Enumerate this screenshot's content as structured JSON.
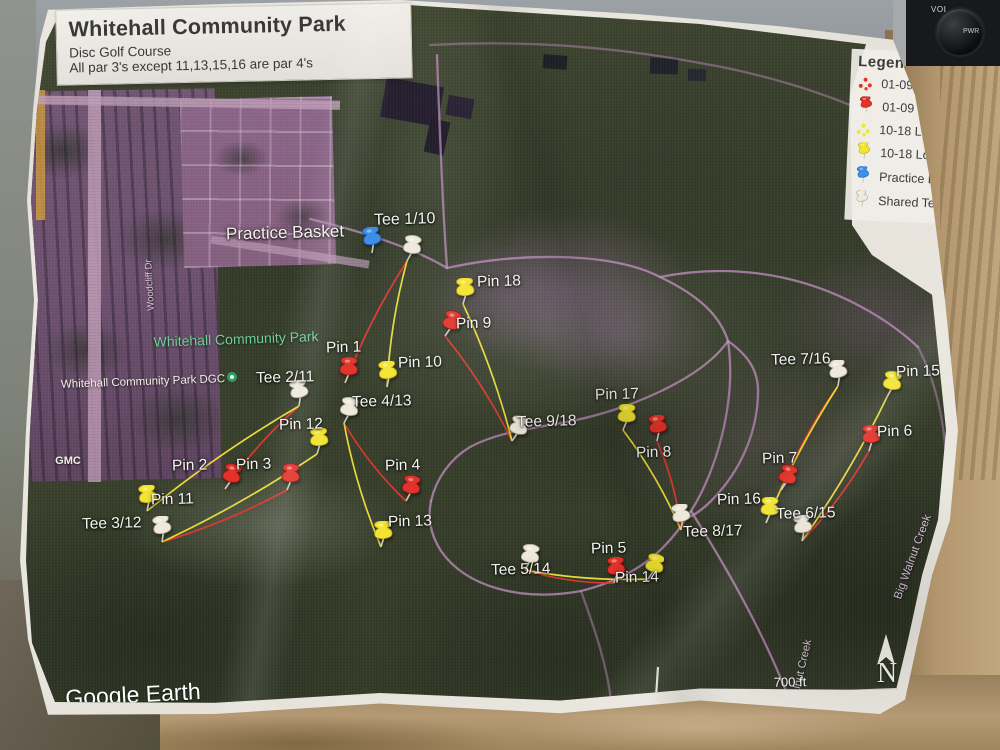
{
  "photo": {
    "radio": {
      "vol": "VOL",
      "pwr": "PWR"
    }
  },
  "header": {
    "title": "Whitehall Community Park",
    "subtitle": "Disc Golf Course",
    "par_note": "All par 3's except 11,13,15,16 are par 4's"
  },
  "legend": {
    "title": "Legend",
    "items": [
      {
        "icon": "dots-short",
        "label": "01-09 Short Holes"
      },
      {
        "icon": "pin-short",
        "label": "01-09 Short Pins"
      },
      {
        "icon": "dots-long",
        "label": "10-18 Long Holes"
      },
      {
        "icon": "pin-long",
        "label": "10-18 Long Pins"
      },
      {
        "icon": "pin-practice",
        "label": "Practice Basket"
      },
      {
        "icon": "pin-tee",
        "label": "Shared Tee Pads"
      }
    ]
  },
  "map": {
    "colors": {
      "short": "#e23229",
      "short_edge": "#8e1613",
      "short_line": "#e0392f",
      "long": "#f2e430",
      "long_edge": "#b8a51a",
      "long_line": "#efe23c",
      "tee": "#efe9dc",
      "tee_edge": "#a39c8e",
      "practice": "#3e8ee6",
      "practice_edge": "#1c5fae",
      "trail": "#c08ec0"
    },
    "markers": [
      {
        "id": "practice-basket",
        "type": "blue",
        "x": 372,
        "y": 253,
        "label": "Practice Basket",
        "dx": -146,
        "dy": -30,
        "size": 17
      },
      {
        "id": "tee-1-10",
        "type": "white",
        "x": 407,
        "y": 261,
        "label": "Tee 1/10",
        "dx": -33,
        "dy": -50,
        "size": 16
      },
      {
        "id": "pin-18",
        "type": "yellow",
        "x": 463,
        "y": 304,
        "label": "Pin 18",
        "dx": 14,
        "dy": -31
      },
      {
        "id": "pin-9",
        "type": "red",
        "x": 445,
        "y": 336,
        "label": "Pin 9",
        "dx": 11,
        "dy": -21
      },
      {
        "id": "pin-1",
        "type": "red",
        "x": 345,
        "y": 383,
        "label": "Pin 1",
        "dx": -19,
        "dy": -44
      },
      {
        "id": "pin-10",
        "type": "yellow",
        "x": 387,
        "y": 387,
        "label": "Pin 10",
        "dx": 11,
        "dy": -33
      },
      {
        "id": "tee-2-11",
        "type": "white",
        "x": 299,
        "y": 406,
        "label": "Tee 2/11",
        "dx": -43,
        "dy": -37
      },
      {
        "id": "tee-4-13",
        "type": "white",
        "x": 344,
        "y": 423,
        "label": "Tee 4/13",
        "dx": 8,
        "dy": -30
      },
      {
        "id": "pin-12",
        "type": "yellow",
        "x": 317,
        "y": 454,
        "label": "Pin 12",
        "dx": -38,
        "dy": -38
      },
      {
        "id": "pin-2",
        "type": "red",
        "x": 225,
        "y": 489,
        "label": "Pin 2",
        "dx": -53,
        "dy": -32
      },
      {
        "id": "pin-3",
        "type": "red",
        "x": 287,
        "y": 490,
        "label": "Pin 3",
        "dx": -51,
        "dy": -34
      },
      {
        "id": "pin-11",
        "type": "yellow",
        "x": 147,
        "y": 511,
        "label": "Pin 11",
        "dx": 4,
        "dy": -20
      },
      {
        "id": "tee-3-12",
        "type": "white",
        "x": 162,
        "y": 542,
        "label": "Tee 3/12",
        "dx": -80,
        "dy": -27
      },
      {
        "id": "pin-4",
        "type": "red",
        "x": 406,
        "y": 501,
        "label": "Pin 4",
        "dx": -21,
        "dy": -44
      },
      {
        "id": "pin-13",
        "type": "yellow",
        "x": 381,
        "y": 547,
        "label": "Pin 13",
        "dx": 7,
        "dy": -34
      },
      {
        "id": "tee-9-18",
        "type": "white",
        "x": 512,
        "y": 441,
        "label": "Tee 9/18",
        "dx": 5,
        "dy": -28
      },
      {
        "id": "pin-17",
        "type": "yellow",
        "x": 623,
        "y": 430,
        "label": "Pin 17",
        "dx": -28,
        "dy": -44
      },
      {
        "id": "pin-8",
        "type": "red",
        "x": 657,
        "y": 441,
        "label": "Pin 8",
        "dx": -21,
        "dy": 3
      },
      {
        "id": "tee-7-16",
        "type": "white",
        "x": 838,
        "y": 386,
        "label": "Tee 7/16",
        "dx": -67,
        "dy": -35
      },
      {
        "id": "pin-15",
        "type": "yellow",
        "x": 887,
        "y": 397,
        "label": "Pin 15",
        "dx": 9,
        "dy": -34
      },
      {
        "id": "pin-6",
        "type": "red",
        "x": 869,
        "y": 451,
        "label": "Pin 6",
        "dx": 8,
        "dy": -28
      },
      {
        "id": "pin-7",
        "type": "red",
        "x": 781,
        "y": 490,
        "label": "Pin 7",
        "dx": -19,
        "dy": -40
      },
      {
        "id": "pin-16",
        "type": "yellow",
        "x": 766,
        "y": 523,
        "label": "Pin 16",
        "dx": -49,
        "dy": -32
      },
      {
        "id": "tee-6-15",
        "type": "white",
        "x": 802,
        "y": 541,
        "label": "Tee 6/15",
        "dx": -26,
        "dy": -36
      },
      {
        "id": "tee-8-17",
        "type": "white",
        "x": 681,
        "y": 530,
        "label": "Tee 8/17",
        "dx": 2,
        "dy": -7
      },
      {
        "id": "tee-5-14",
        "type": "white",
        "x": 525,
        "y": 570,
        "label": "Tee 5/14",
        "dx": -34,
        "dy": -9
      },
      {
        "id": "pin-5",
        "type": "red",
        "x": 614,
        "y": 583,
        "label": "Pin 5",
        "dx": -23,
        "dy": -43
      },
      {
        "id": "pin-14",
        "type": "yellow",
        "x": 648,
        "y": 579,
        "label": "Pin 14",
        "dx": -33,
        "dy": -10
      }
    ],
    "fairways": [
      {
        "hole": "1",
        "from": "tee-1-10",
        "to": "pin-1",
        "type": "short"
      },
      {
        "hole": "10",
        "from": "tee-1-10",
        "to": "pin-10",
        "type": "long"
      },
      {
        "hole": "2",
        "from": "tee-2-11",
        "to": "pin-2",
        "type": "short"
      },
      {
        "hole": "11",
        "from": "tee-2-11",
        "to": "pin-11",
        "type": "long"
      },
      {
        "hole": "3",
        "from": "tee-3-12",
        "to": "pin-3",
        "type": "short"
      },
      {
        "hole": "12",
        "from": "tee-3-12",
        "to": "pin-12",
        "type": "long"
      },
      {
        "hole": "4",
        "from": "tee-4-13",
        "to": "pin-4",
        "type": "short"
      },
      {
        "hole": "13",
        "from": "tee-4-13",
        "to": "pin-13",
        "type": "long"
      },
      {
        "hole": "5",
        "from": "tee-5-14",
        "to": "pin-5",
        "type": "short"
      },
      {
        "hole": "14",
        "from": "tee-5-14",
        "to": "pin-14",
        "type": "long"
      },
      {
        "hole": "6",
        "from": "tee-6-15",
        "to": "pin-6",
        "type": "short"
      },
      {
        "hole": "15",
        "from": "tee-6-15",
        "to": "pin-15",
        "type": "long"
      },
      {
        "hole": "7",
        "from": "tee-7-16",
        "to": "pin-7",
        "type": "short"
      },
      {
        "hole": "16",
        "from": "tee-7-16",
        "to": "pin-16",
        "type": "long"
      },
      {
        "hole": "8",
        "from": "tee-8-17",
        "to": "pin-8",
        "type": "short"
      },
      {
        "hole": "17",
        "from": "tee-8-17",
        "to": "pin-17",
        "type": "long"
      },
      {
        "hole": "9",
        "from": "tee-9-18",
        "to": "pin-9",
        "type": "short"
      },
      {
        "hole": "18",
        "from": "tee-9-18",
        "to": "pin-18",
        "type": "long"
      }
    ],
    "annotations": [
      {
        "id": "park-name",
        "text": "Whitehall Community Park",
        "x": 236,
        "y": 339,
        "size": 14,
        "color": "#6fcf97",
        "rot": -2
      },
      {
        "id": "park-poi",
        "text": "Whitehall Community Park DGC",
        "x": 143,
        "y": 382,
        "size": 11.5,
        "color": "#f2efe8",
        "rot": -2
      },
      {
        "id": "gmc",
        "text": "GMC",
        "x": 68,
        "y": 461,
        "size": 11,
        "color": "#f2efe8",
        "rot": 0,
        "bold": true
      },
      {
        "id": "road-woodcliff",
        "text": "Woodcliff Dr",
        "x": 150,
        "y": 285,
        "size": 9.5,
        "color": "#dcc8dc",
        "rot": -93
      },
      {
        "id": "big-walnut-creek",
        "text": "Big Walnut Creek",
        "x": 913,
        "y": 557,
        "size": 11.5,
        "color": "#d9bfdb",
        "rot": -70
      },
      {
        "id": "walnut-creek",
        "text": "Walnut Creek",
        "x": 801,
        "y": 672,
        "size": 11,
        "color": "#d9c6d9",
        "rot": -77
      },
      {
        "id": "google-earth",
        "text": "Google Earth",
        "x": 133,
        "y": 695,
        "size": 23,
        "color": "#ffffff",
        "rot": -3
      },
      {
        "id": "scale-text",
        "text": "700 ft",
        "x": 790,
        "y": 682,
        "size": 13,
        "color": "#ffffff",
        "rot": -1
      },
      {
        "id": "compass-n",
        "text": "N",
        "x": 887,
        "y": 674,
        "size": 28,
        "color": "#f4f2ec",
        "rot": 0,
        "serif": true
      }
    ]
  }
}
